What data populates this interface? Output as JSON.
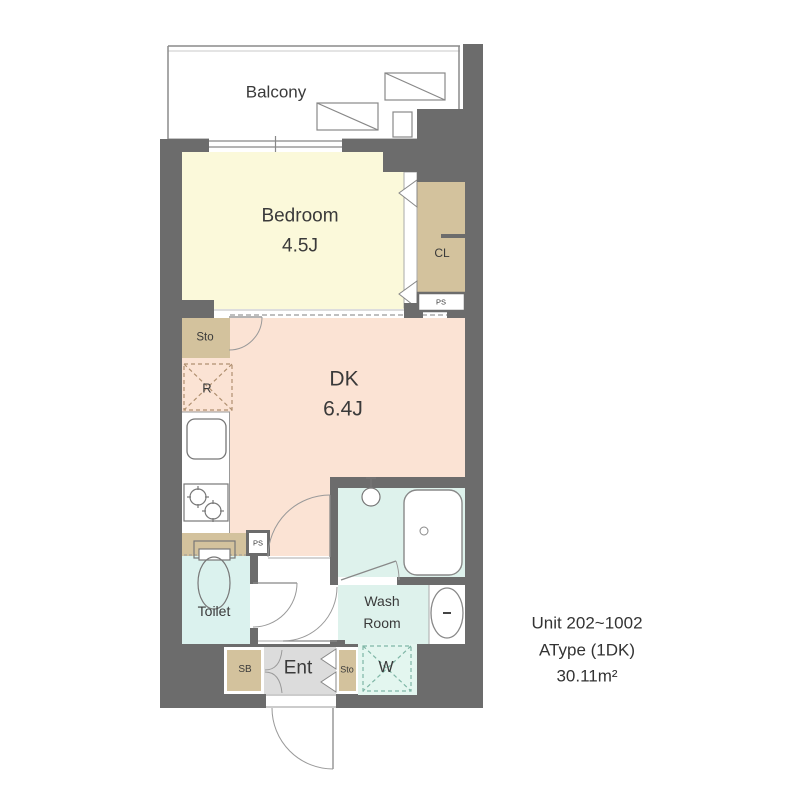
{
  "floorplan": {
    "info": {
      "line1": "Unit 202~1002",
      "line2": "AType (1DK)",
      "line3": "30.11m²"
    },
    "rooms": {
      "balcony": {
        "label": "Balcony"
      },
      "bedroom": {
        "label": "Bedroom",
        "size": "4.5J"
      },
      "dk": {
        "label": "DK",
        "size": "6.4J"
      },
      "closet": {
        "label": "CL"
      },
      "pipe_space_upper": {
        "label": "PS"
      },
      "storage_upper": {
        "label": "Sto"
      },
      "refrigerator_space": {
        "label": "R"
      },
      "pipe_space_lower": {
        "label": "PS"
      },
      "toilet": {
        "label": "Toilet"
      },
      "washroom": {
        "label_line1": "Wash",
        "label_line2": "Room"
      },
      "entrance": {
        "label": "Ent"
      },
      "shoe_box": {
        "label": "SB"
      },
      "storage_lower": {
        "label": "Sto"
      },
      "washer_space": {
        "label": "W"
      }
    },
    "colors": {
      "wall": "#6C6C6C",
      "bedroom": "#FBF9DA",
      "dk": "#FBE3D4",
      "tan": "#D3C29D",
      "bath_mint": "#DEF2EC",
      "toilet_mint": "#DBF2EE",
      "washer_bg": "#E3F6EF",
      "entrance_gray": "#DCDCDC",
      "white": "#FFFFFF",
      "outline": "#8A8A8A",
      "fixture": "#777777",
      "dash_warm": "#B09070",
      "dash_teal": "#7FB6A6"
    }
  }
}
